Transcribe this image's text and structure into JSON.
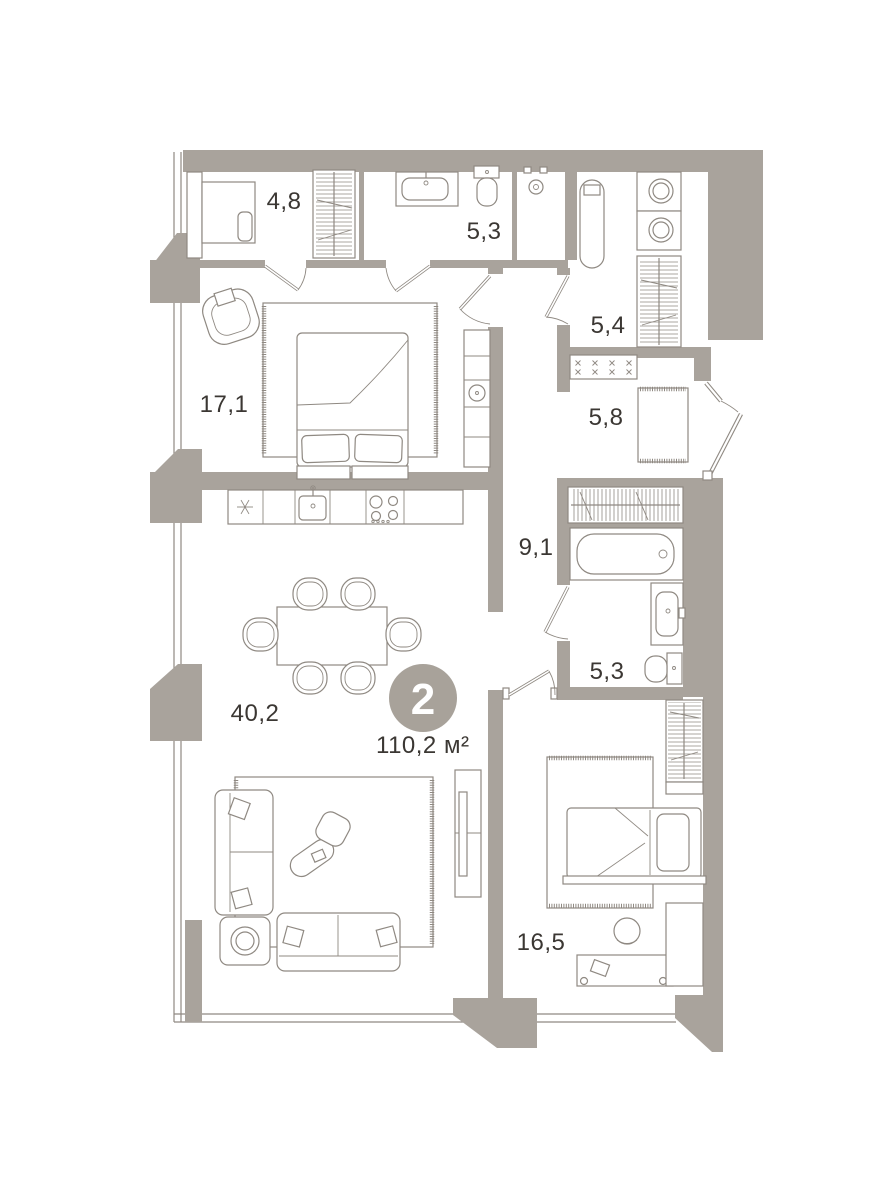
{
  "plan": {
    "type": "apartment-floor-plan",
    "badge": {
      "rooms_count": "2",
      "total_area": "110,2 м²"
    },
    "rooms": [
      {
        "name": "wardrobe",
        "area_label": "4,8"
      },
      {
        "name": "bathroom-top",
        "area_label": "5,3"
      },
      {
        "name": "laundry",
        "area_label": "5,4"
      },
      {
        "name": "entry-hall",
        "area_label": "5,8"
      },
      {
        "name": "master-bedroom",
        "area_label": "17,1"
      },
      {
        "name": "corridor",
        "area_label": "9,1"
      },
      {
        "name": "bathroom-main",
        "area_label": "5,3"
      },
      {
        "name": "living-kitchen",
        "area_label": "40,2"
      },
      {
        "name": "bedroom",
        "area_label": "16,5"
      }
    ],
    "colors": {
      "wall": "#a9a39c",
      "line": "#8f8982",
      "text": "#3b3733",
      "badge_fill": "#a8a29a",
      "badge_text": "#ffffff",
      "background": "#ffffff"
    }
  }
}
